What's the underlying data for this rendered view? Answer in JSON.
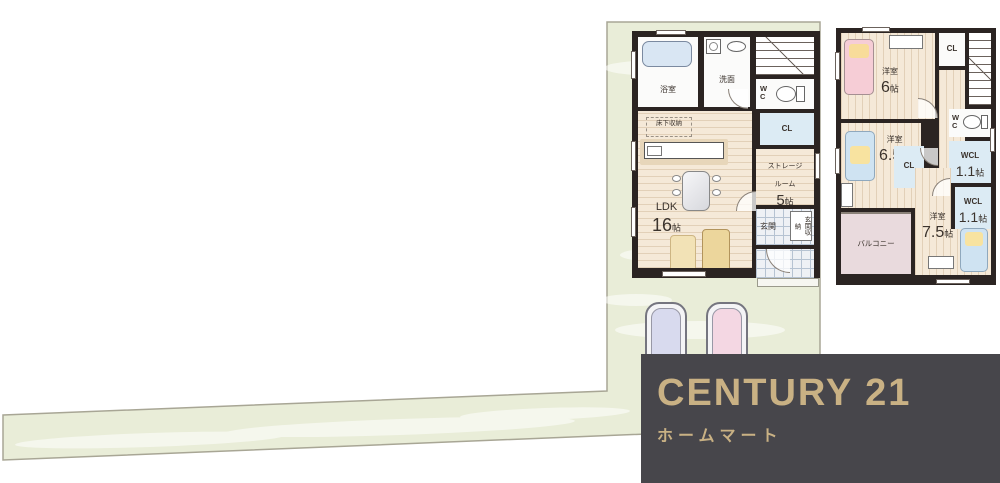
{
  "lot": {
    "fill": "#e9edd8",
    "border": "#a8a695"
  },
  "colors": {
    "wall": "#2b2422",
    "wood_floor": "#f5e9d8",
    "closet_blue": "#dcebf4",
    "balcony_pink": "#e9dadd",
    "logo_bg": "#47464b",
    "logo_gold": "#c9b184",
    "car_blue": "#d8daee",
    "car_pink": "#f4d7e3"
  },
  "floor1": {
    "bath_label": "浴室",
    "wash_label": "洗面",
    "wc_label": "WC",
    "cl_label": "CL",
    "underfloor_label": "床下収納",
    "ldk_label": "LDK",
    "ldk_size_num": "16",
    "ldk_size_unit": "帖",
    "storage_label_1": "ストレージ",
    "storage_label_2": "ルーム",
    "storage_size_num": "5",
    "storage_size_unit": "帖",
    "entrance_label": "玄関",
    "entrance_storage_label": "玄関収納"
  },
  "floor2": {
    "room6_label": "洋室",
    "room6_size_num": "6",
    "room6_size_unit": "帖",
    "cl_top_label": "CL",
    "wc_label": "WC",
    "wcl1_label": "WCL",
    "wcl1_size_num": "1.1",
    "wcl1_size_unit": "帖",
    "wcl2_label": "WCL",
    "wcl2_size_num": "1.1",
    "wcl2_size_unit": "帖",
    "room65_label": "洋室",
    "room65_size_num": "6.5",
    "room65_size_unit": "帖",
    "cl_mid_label": "CL",
    "balcony_label": "バルコニー",
    "room75_label": "洋室",
    "room75_size_num": "7.5",
    "room75_size_unit": "帖"
  },
  "logo": {
    "brand": "CENTURY 21",
    "company": "ホームマート"
  }
}
